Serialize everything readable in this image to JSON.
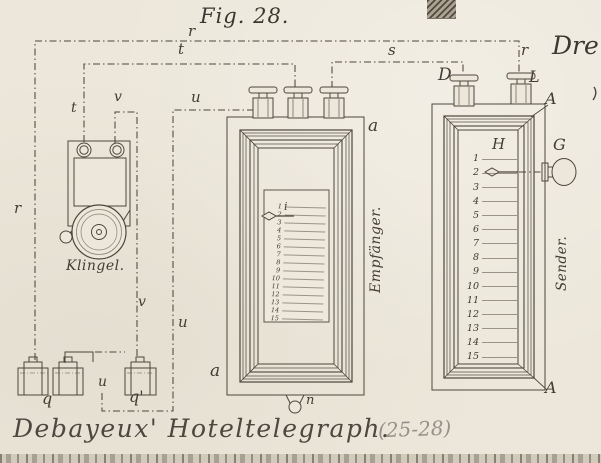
{
  "figure": {
    "title": "Fig. 28.",
    "caption": "Debayeux' Hoteltelegraph.",
    "caption_ref": "(25-28)",
    "corner_text": "Dre"
  },
  "colors": {
    "paper": "#ece7da",
    "ink": "#4c463c",
    "faint": "#857d6d"
  },
  "wires": {
    "r_top": "r",
    "r_left": "r",
    "r_right": "r",
    "t_top": "t",
    "t_bell": "t",
    "s": "s",
    "u_top": "u",
    "u_mid": "u",
    "u_bottom": "u",
    "v_top": "v",
    "v_mid": "v"
  },
  "bell": {
    "label": "Klingel."
  },
  "battery": {
    "left_label": "q",
    "right_label": "q'"
  },
  "receiver": {
    "label": "Empfänger.",
    "terminal_label_top": "a",
    "terminal_label_bottom": "a",
    "knob_label": "n",
    "pointer_label": "i",
    "scale": [
      "1",
      "2",
      "3",
      "4",
      "5",
      "6",
      "7",
      "8",
      "9",
      "10",
      "11",
      "12",
      "13",
      "14",
      "15"
    ]
  },
  "sender": {
    "label": "Sender.",
    "header_label": "H",
    "knob_label": "G",
    "post_left_label": "D",
    "post_right_label": "L",
    "corner_label_top": "A",
    "corner_label_bottom": "A",
    "scale": [
      "1",
      "2",
      "3",
      "4",
      "5",
      "6",
      "7",
      "8",
      "9",
      "10",
      "11",
      "12",
      "13",
      "14",
      "15"
    ]
  }
}
